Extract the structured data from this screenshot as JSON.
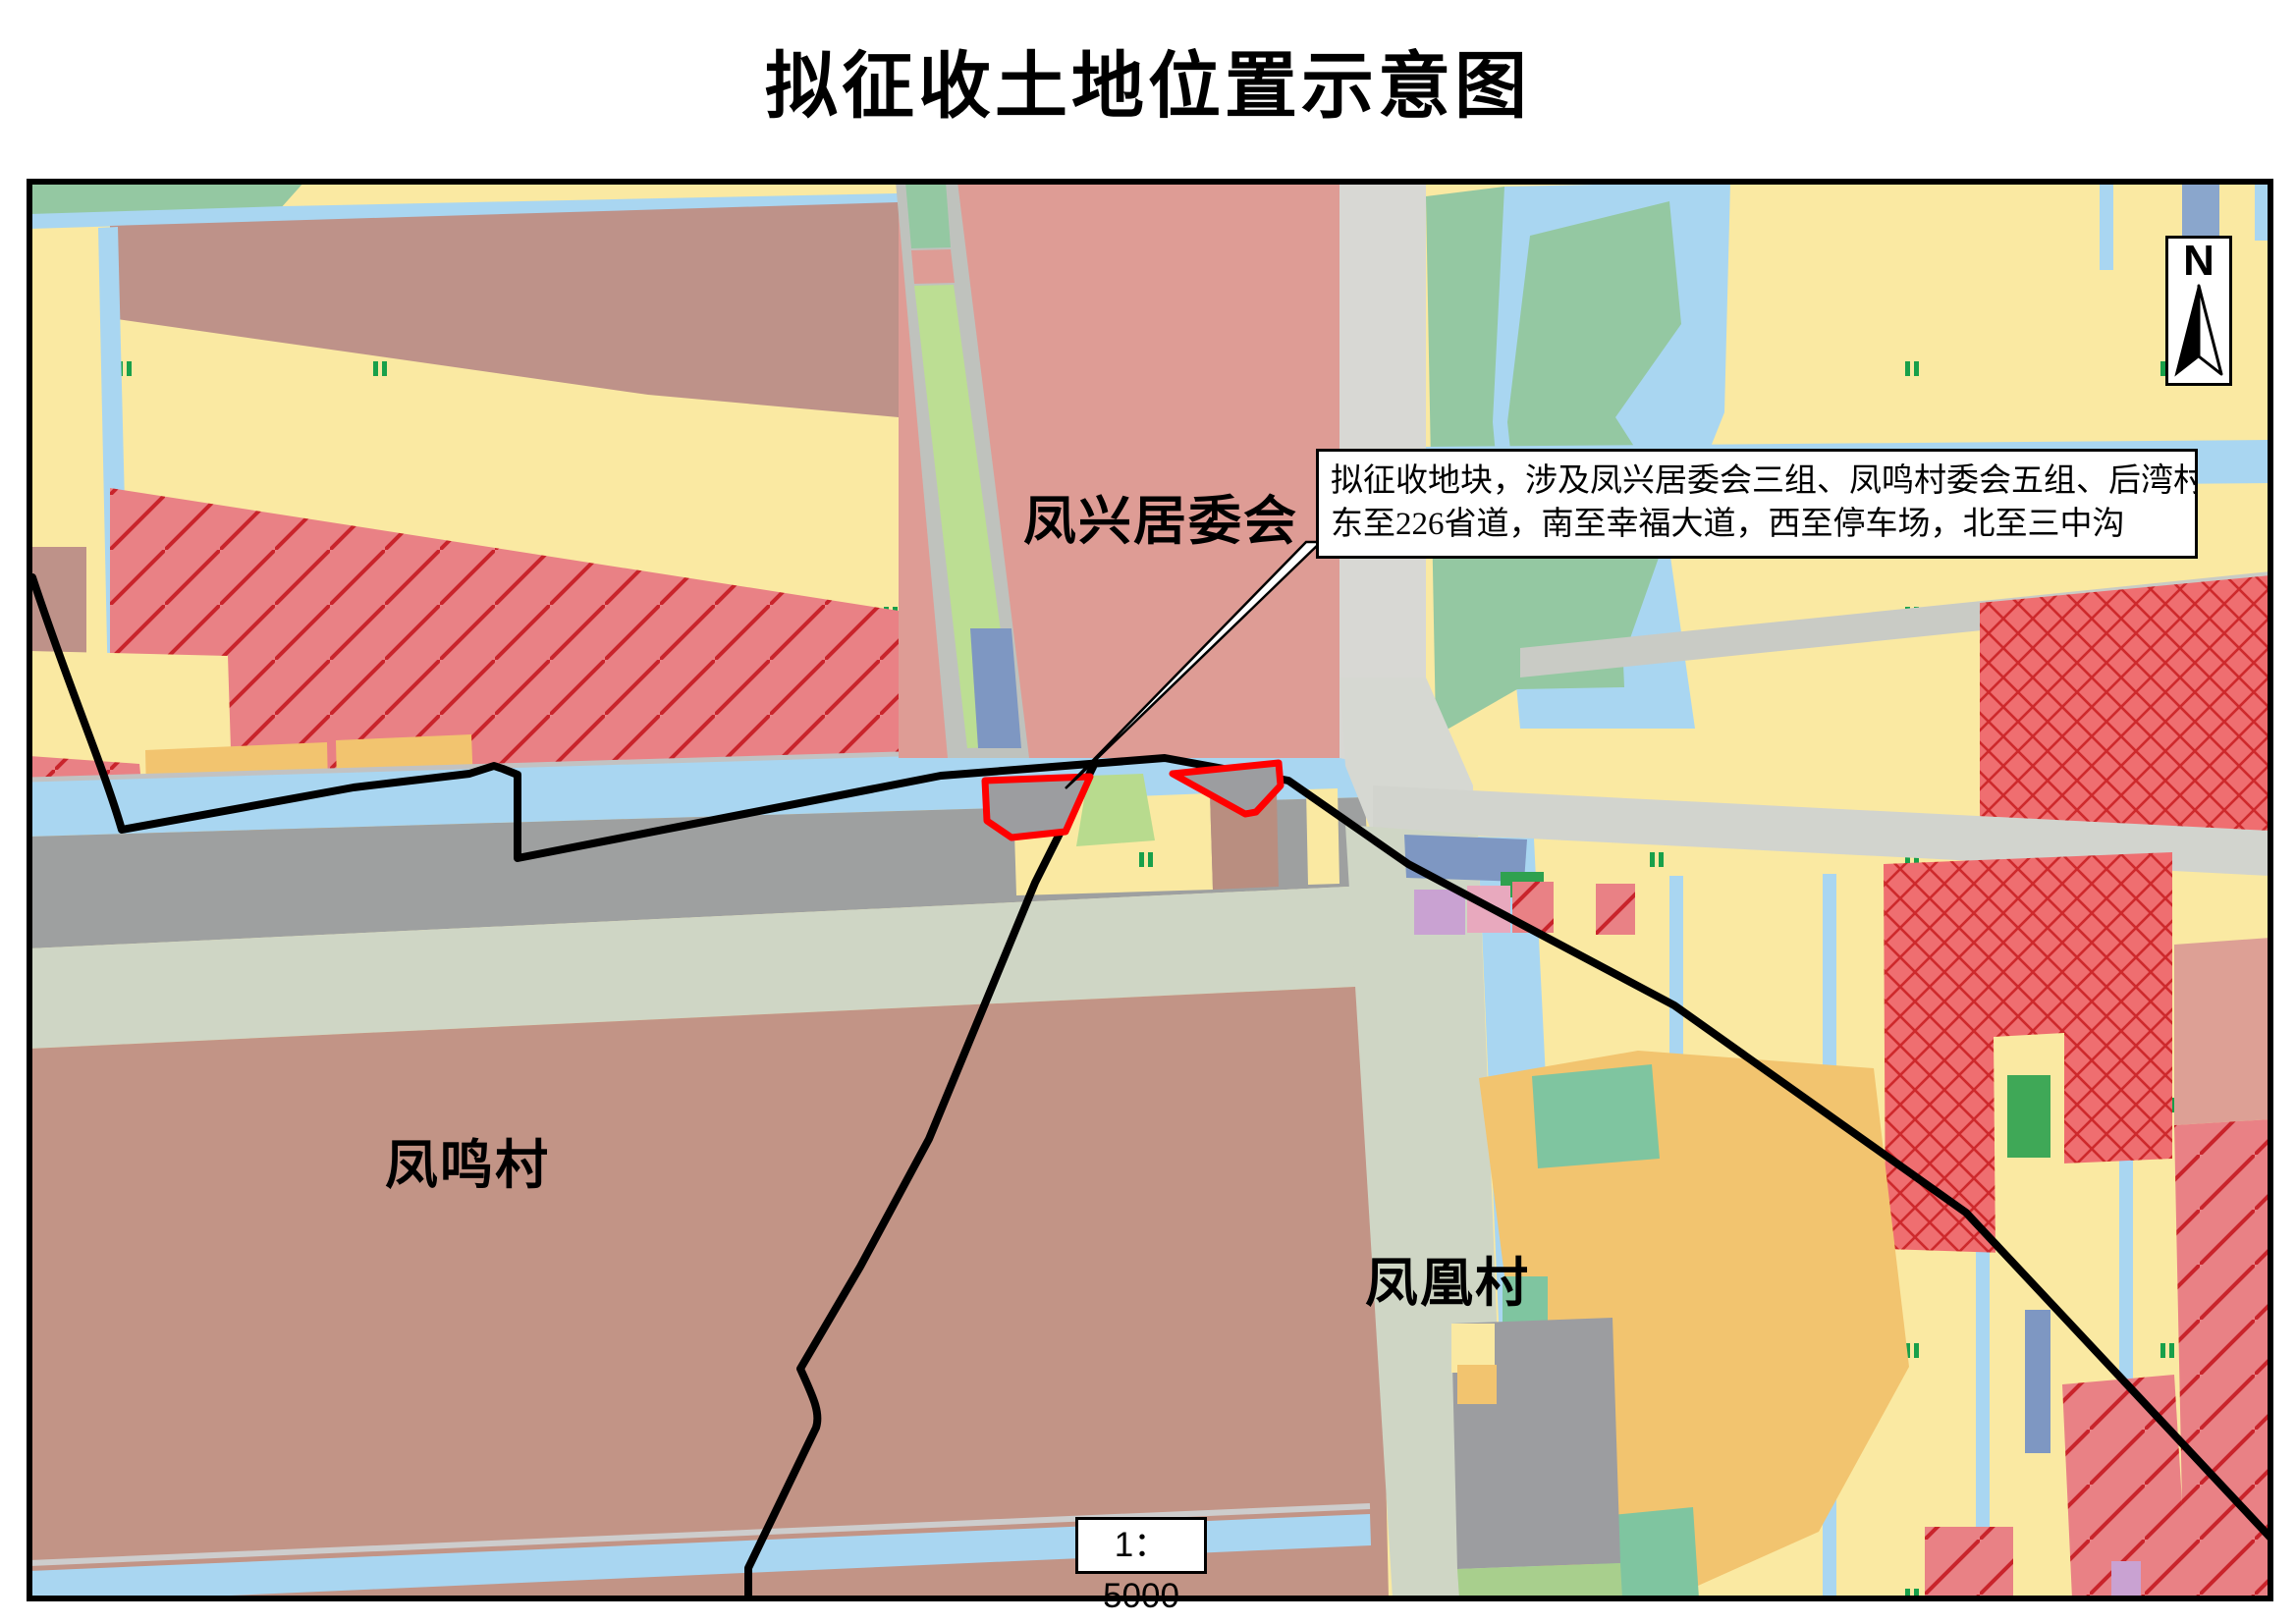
{
  "title": "拟征收土地位置示意图",
  "map": {
    "labels": {
      "fengxing": "凤兴居委会",
      "fengming": "凤鸣村",
      "fenghuang": "凤凰村"
    },
    "annotation": {
      "line1": "拟征收地块，涉及凤兴居委会三组、凤鸣村委会五组、后湾村委会六组",
      "line2": "东至226省道，南至幸福大道，西至停车场，北至三中沟"
    },
    "scale_text": "1：5000",
    "north_label": "N",
    "colors": {
      "parcel_outline": "#FF0000",
      "boundary_line": "#000000",
      "field_yellow": "#FAE9A2",
      "paddy_mark_green": "#18A04A",
      "water_blue": "#A9D6F1",
      "wetland_teal": "#94C8A2",
      "greenbelt": "#BCDE93",
      "residential_salmon": "#DE9C95",
      "village_mauve": "#C29486",
      "mauve_band": "#BE9289",
      "red_hatch_fill": "#E98185",
      "red_hatch_line": "#C9242B",
      "red_cross_fill": "#EF6E70",
      "red_cross_line": "#CE292C",
      "urban_gray": "#9EA0A0",
      "road_light": "#CFD6C5",
      "road_gray": "#D8D8D4",
      "orchard_orange": "#F2C46F",
      "blue_gray": "#7E97C2",
      "purple": "#C9A2D2",
      "pink": "#E8A9BE"
    }
  }
}
